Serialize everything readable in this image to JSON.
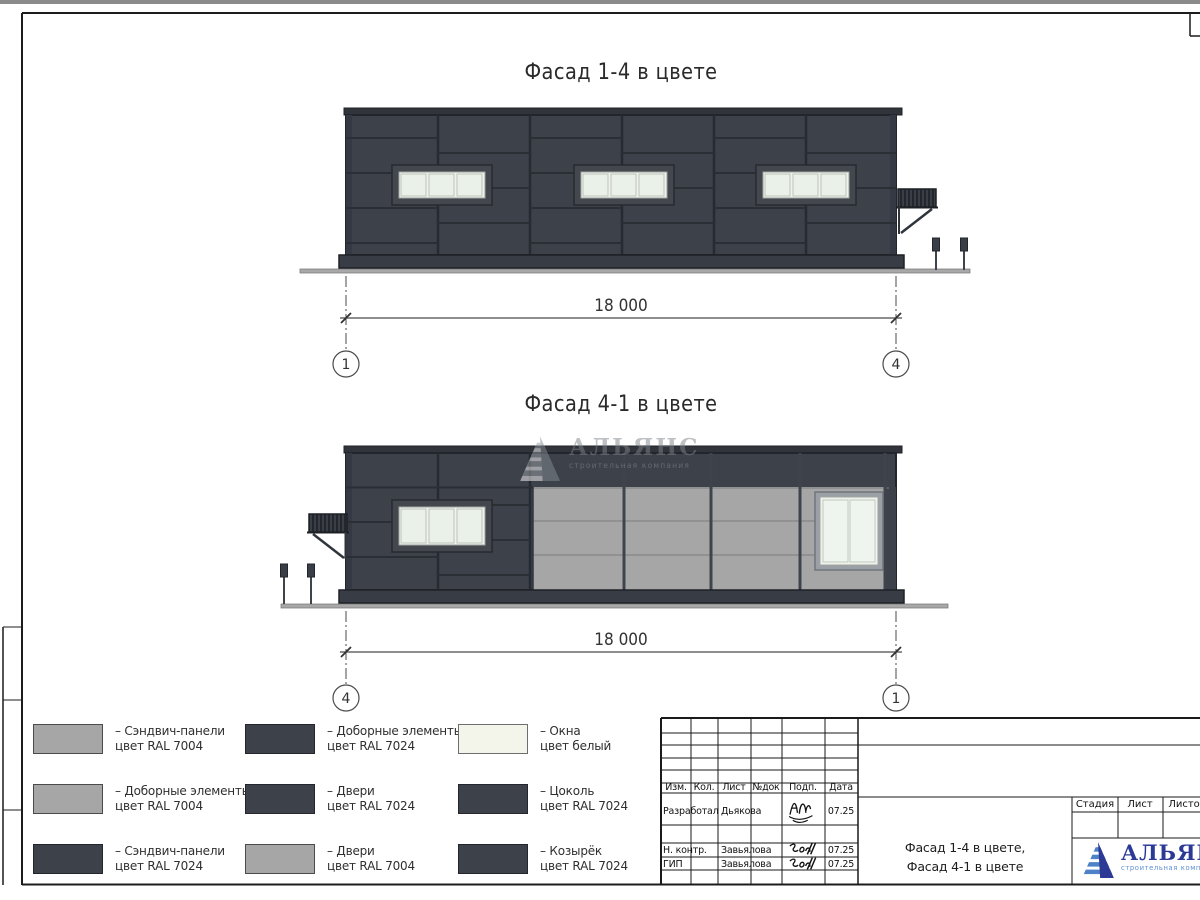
{
  "window": {
    "top_bar_color": "#8b8b8b"
  },
  "facade1": {
    "title": "Фасад 1-4 в цвете",
    "dim_label": "18 000",
    "axis_left": "1",
    "axis_right": "4"
  },
  "facade2": {
    "title": "Фасад 4-1 в цвете",
    "dim_label": "18 000",
    "axis_left": "4",
    "axis_right": "1"
  },
  "watermark": {
    "name": "АЛЬЯНС",
    "subtitle": "строительная компания"
  },
  "legend": {
    "items": [
      {
        "line1": "– Сэндвич-панели",
        "line2": "цвет RAL 7004",
        "swatch_style": "background:#a6a6a6;border-color:#4b4b4b"
      },
      {
        "line1": "– Доборные элементы",
        "line2": "цвет RAL 7004",
        "swatch_style": "background:#a6a6a6;border-color:#4b4b4b"
      },
      {
        "line1": "– Сэндвич-панели",
        "line2": "цвет RAL 7024",
        "swatch_style": "background:#3c414a;border-color:#23262c"
      },
      {
        "line1": "– Доборные элементы",
        "line2": "цвет RAL 7024",
        "swatch_style": "background:#3c414a;border-color:#23262c"
      },
      {
        "line1": "– Двери",
        "line2": "цвет RAL 7024",
        "swatch_style": "background:#3c414a;border-color:#23262c"
      },
      {
        "line1": "– Двери",
        "line2": "цвет RAL 7004",
        "swatch_style": "background:#a6a6a6;border-color:#4b4b4b"
      },
      {
        "line1": "– Окна",
        "line2": "цвет белый",
        "swatch_style": "background:#f3f4ea;border-color:#6e6e6e"
      },
      {
        "line1": "– Цоколь",
        "line2": "цвет RAL 7024",
        "swatch_style": "background:#3c414a;border-color:#23262c"
      },
      {
        "line1": "– Козырёк",
        "line2": "цвет RAL 7024",
        "swatch_style": "background:#3c414a;border-color:#23262c"
      }
    ]
  },
  "titleblock": {
    "revision_headers": [
      "Изм.",
      "Кол.",
      "Лист",
      "№док",
      "Подп.",
      "Дата"
    ],
    "signature_rows": [
      {
        "role": "Разработал",
        "name": "Дьякова",
        "date": "07.25"
      },
      {
        "role": "Н. контр.",
        "name": "Завьялова",
        "date": "07.25"
      },
      {
        "role": "ГИП",
        "name": "Завьялова",
        "date": "07.25"
      }
    ],
    "stage_headers": [
      "Стадия",
      "Лист",
      "Листов"
    ],
    "doc_title_line1": "Фасад 1-4 в цвете,",
    "doc_title_line2": "Фасад 4-1 в цвете",
    "logo": {
      "name": "АЛЬЯНС",
      "subtitle": "строительная компания"
    }
  },
  "colors": {
    "ral7024_dark_panels": "#3c414a",
    "ral7004_light_panels": "#a6a6a6",
    "window_glass": "#e9f1e9",
    "logo_blue": "#2c3a96",
    "logo_blue_light": "#4d82c8"
  }
}
